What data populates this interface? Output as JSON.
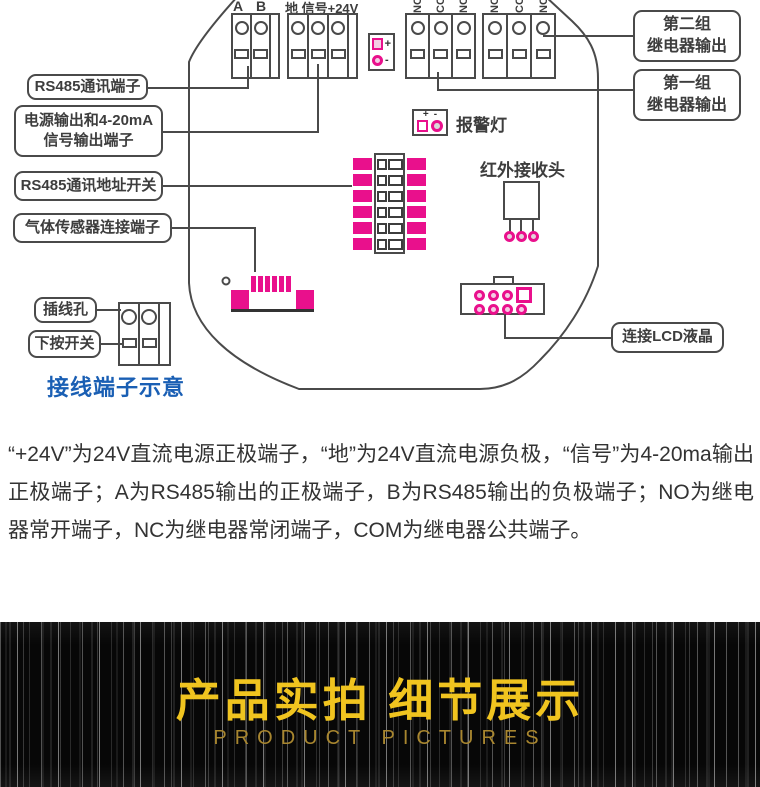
{
  "colors": {
    "accent_magenta": "#e9108c",
    "caption_blue": "#1a5fb4",
    "banner_gold": "#f0c41f",
    "banner_gold_dark": "#a8862f",
    "diagram_stroke": "#4a4a4a"
  },
  "diagram": {
    "terminals": {
      "ab": [
        "A",
        "B"
      ],
      "power_label": "地 信号+24V",
      "relay": [
        "NO",
        "COM",
        "NC"
      ]
    },
    "callouts": {
      "rs485": "RS485通讯端子",
      "power_line1": "电源输出和4-20mA",
      "power_line2": "信号输出端子",
      "address_switch": "RS485通讯地址开关",
      "gas_sensor": "气体传感器连接端子",
      "wire_hole": "插线孔",
      "push_switch": "下按开关",
      "relay_group2_line1": "第二组",
      "relay_group2_line2": "继电器输出",
      "relay_group1_line1": "第一组",
      "relay_group1_line2": "继电器输出",
      "lcd": "连接LCD液晶"
    },
    "labels": {
      "alarm_lamp": "报警灯",
      "ir_receiver": "红外接收头",
      "caption": "接线端子示意",
      "plus": "+",
      "minus": "-"
    }
  },
  "description": "“+24V”为24V直流电源正极端子，“地”为24V直流电源负极，“信号”为4-20ma输出正极端子；A为RS485输出的正极端子，B为RS485输出的负极端子；NO为继电器常开端子，NC为继电器常闭端子，COM为继电器公共端子。",
  "banner": {
    "title": "产品实拍 细节展示",
    "subtitle": "PRODUCT PICTURES"
  }
}
